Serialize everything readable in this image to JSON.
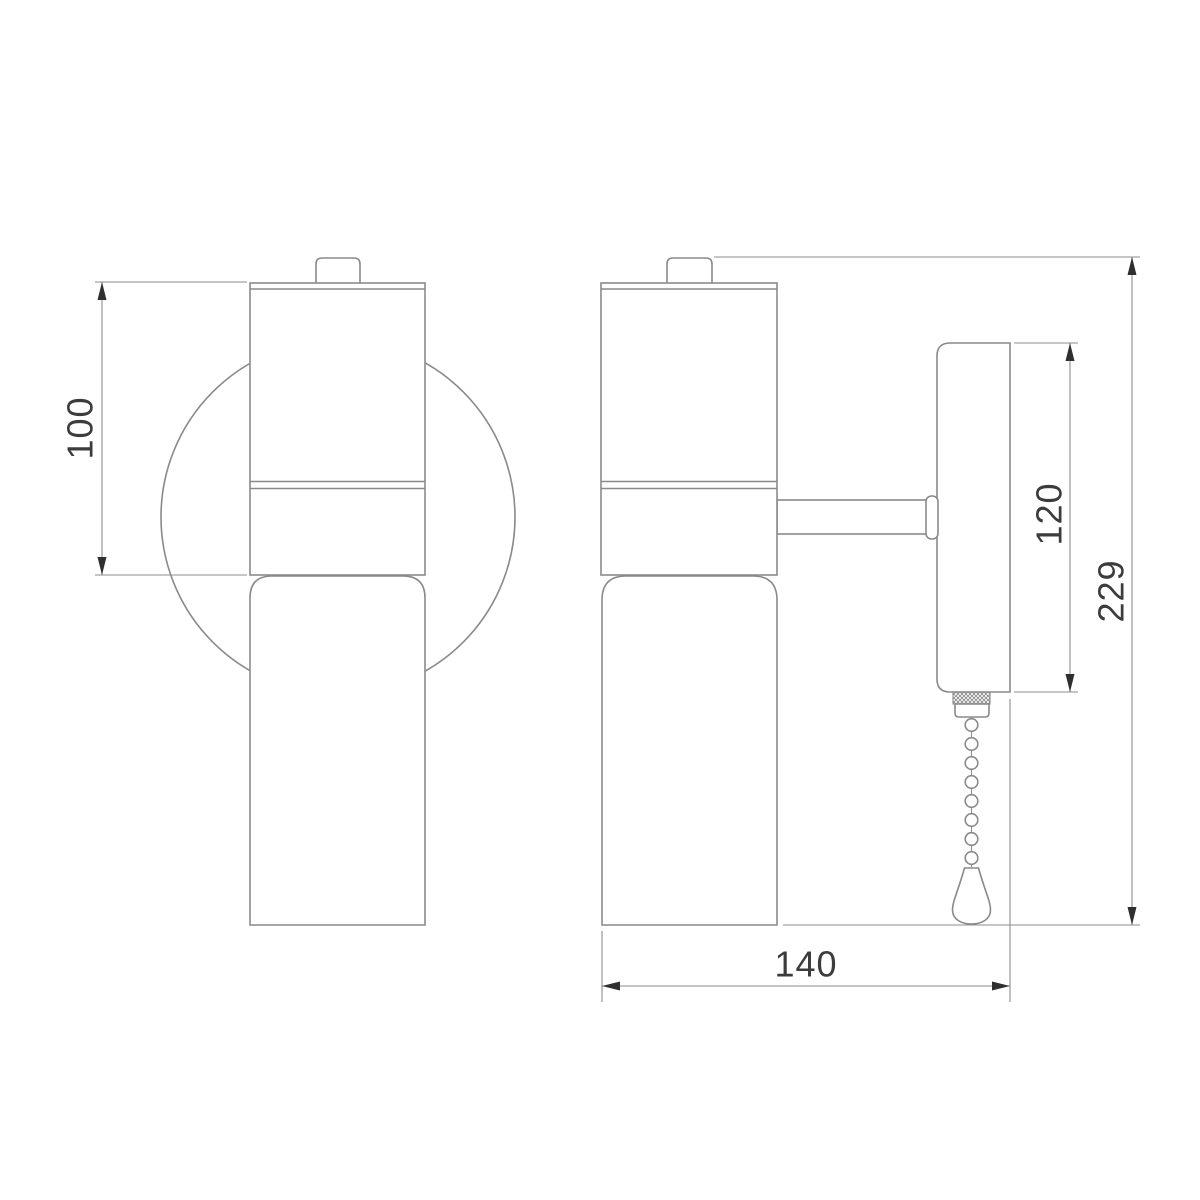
{
  "drawing": {
    "kind": "technical-dimension-drawing",
    "views": {
      "front": {
        "id": "front-view"
      },
      "side": {
        "id": "side-view"
      }
    },
    "dimensions": {
      "lamp_body_height": {
        "value": "100",
        "orientation": "vertical",
        "view": "front"
      },
      "backplate_height": {
        "value": "120",
        "orientation": "vertical",
        "view": "side"
      },
      "overall_height": {
        "value": "229",
        "orientation": "vertical",
        "view": "side"
      },
      "overall_depth": {
        "value": "140",
        "orientation": "horizontal",
        "view": "side"
      }
    },
    "colors": {
      "background": "#ffffff",
      "object_line": "#8a8a8a",
      "dimension_line": "#8e8e8e",
      "arrow_and_text": "#3c3c3c"
    }
  }
}
